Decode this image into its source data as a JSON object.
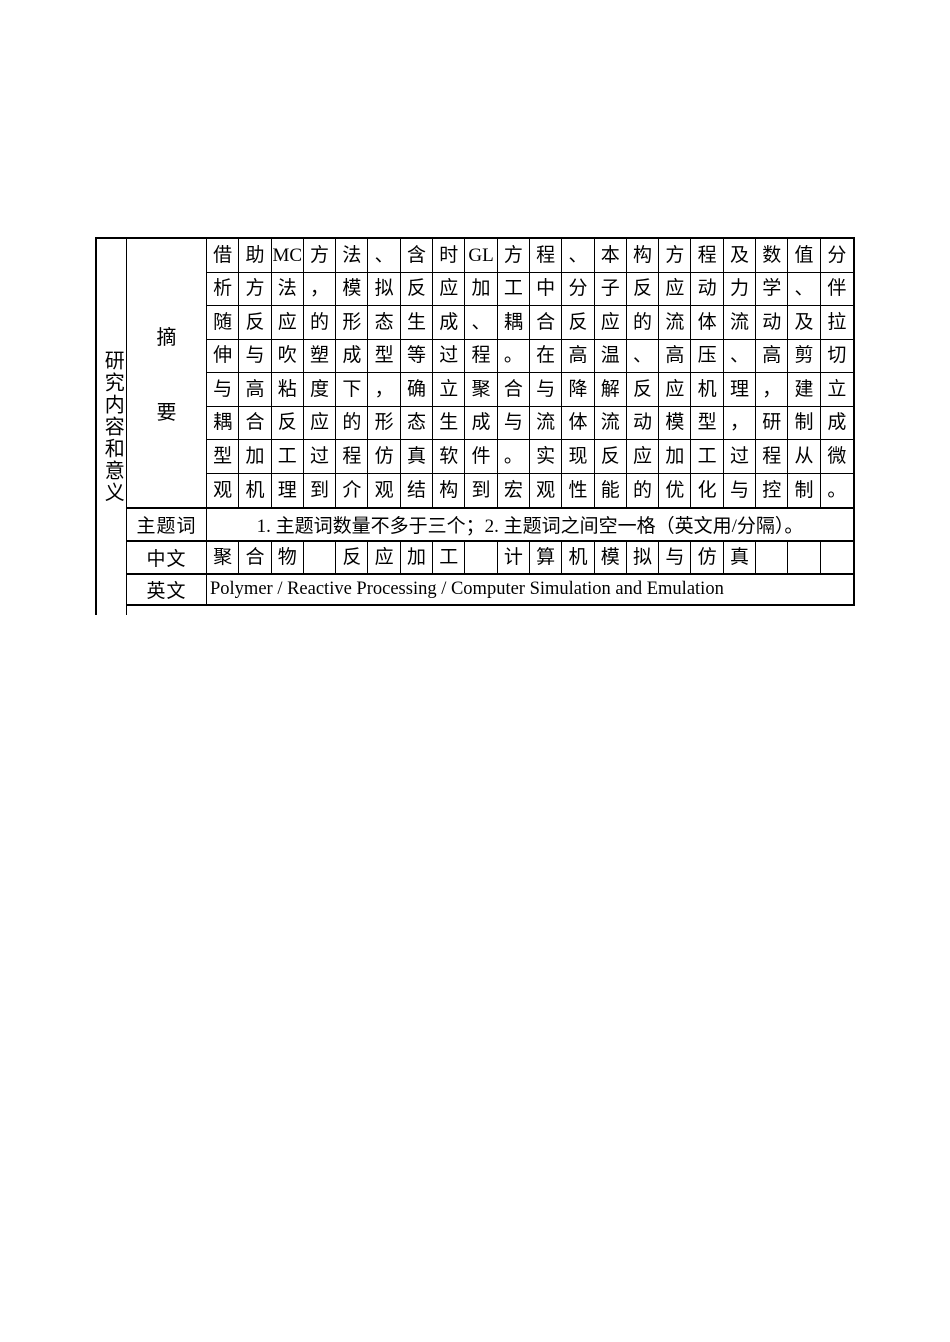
{
  "table": {
    "row_header": {
      "label": "研究内容和意义"
    },
    "abstract": {
      "label_chars": [
        "摘",
        "要"
      ],
      "rows": [
        [
          "借",
          "助",
          "MC",
          "方",
          "法",
          "、",
          "含",
          "时",
          "GL",
          "方",
          "程",
          "、",
          "本",
          "构",
          "方",
          "程",
          "及",
          "数",
          "值",
          "分"
        ],
        [
          "析",
          "方",
          "法",
          "，",
          "模",
          "拟",
          "反",
          "应",
          "加",
          "工",
          "中",
          "分",
          "子",
          "反",
          "应",
          "动",
          "力",
          "学",
          "、",
          "伴"
        ],
        [
          "随",
          "反",
          "应",
          "的",
          "形",
          "态",
          "生",
          "成",
          "、",
          "耦",
          "合",
          "反",
          "应",
          "的",
          "流",
          "体",
          "流",
          "动",
          "及",
          "拉"
        ],
        [
          "伸",
          "与",
          "吹",
          "塑",
          "成",
          "型",
          "等",
          "过",
          "程",
          "。",
          "在",
          "高",
          "温",
          "、",
          "高",
          "压",
          "、",
          "高",
          "剪",
          "切"
        ],
        [
          "与",
          "高",
          "粘",
          "度",
          "下",
          "，",
          "确",
          "立",
          "聚",
          "合",
          "与",
          "降",
          "解",
          "反",
          "应",
          "机",
          "理",
          "，",
          "建",
          "立"
        ],
        [
          "耦",
          "合",
          "反",
          "应",
          "的",
          "形",
          "态",
          "生",
          "成",
          "与",
          "流",
          "体",
          "流",
          "动",
          "模",
          "型",
          "，",
          "研",
          "制",
          "成"
        ],
        [
          "型",
          "加",
          "工",
          "过",
          "程",
          "仿",
          "真",
          "软",
          "件",
          "。",
          "实",
          "现",
          "反",
          "应",
          "加",
          "工",
          "过",
          "程",
          "从",
          "微"
        ],
        [
          "观",
          "机",
          "理",
          "到",
          "介",
          "观",
          "结",
          "构",
          "到",
          "宏",
          "观",
          "性",
          "能",
          "的",
          "优",
          "化",
          "与",
          "控",
          "制",
          "。"
        ]
      ]
    },
    "keywords": {
      "label": "主题词",
      "note": "1. 主题词数量不多于三个；2. 主题词之间空一格（英文用/分隔）。"
    },
    "chinese": {
      "label": "中文",
      "cells": [
        "聚",
        "合",
        "物",
        "",
        "反",
        "应",
        "加",
        "工",
        "",
        "计",
        "算",
        "机",
        "模",
        "拟",
        "与",
        "仿",
        "真",
        "",
        "",
        ""
      ]
    },
    "english": {
      "label": "英文",
      "value": "Polymer / Reactive Processing / Computer Simulation and Emulation"
    }
  }
}
